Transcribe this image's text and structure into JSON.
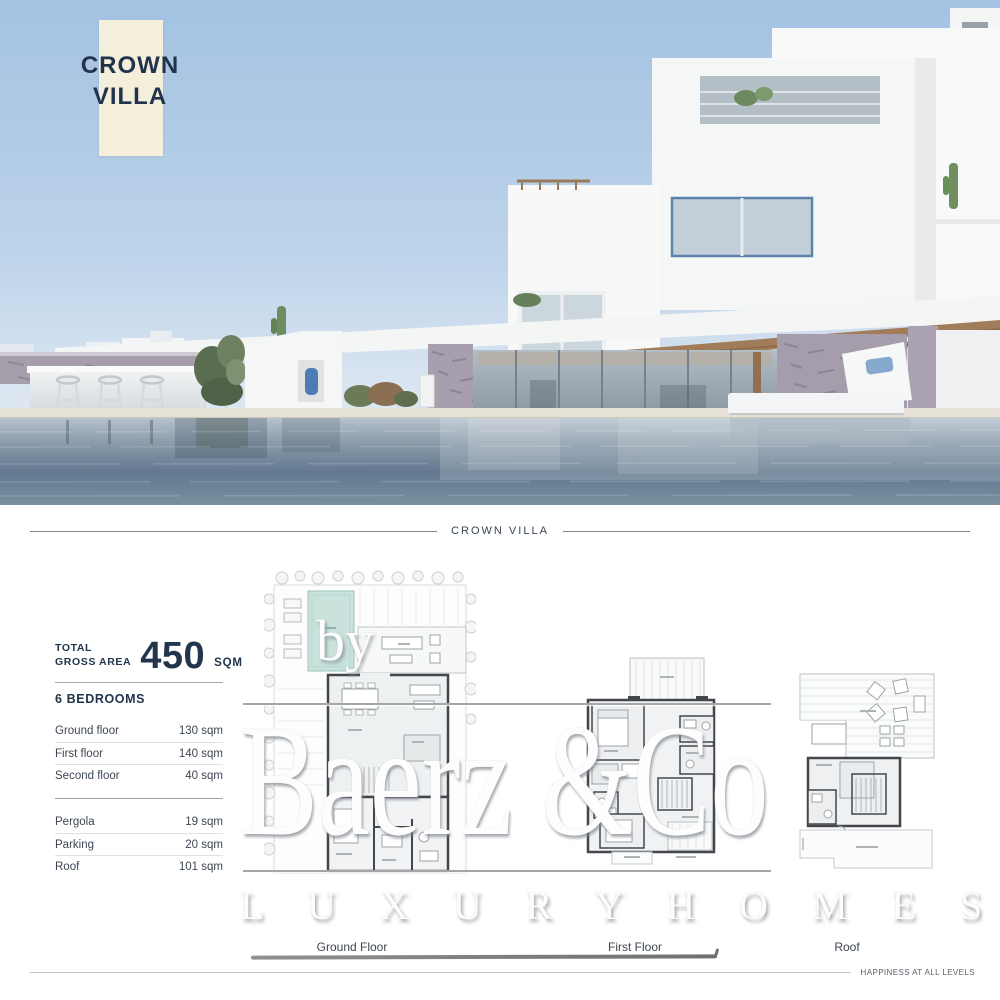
{
  "hero": {
    "card_line1": "CROWN",
    "card_line2": "VILLA"
  },
  "section_divider": {
    "title": "CROWN VILLA"
  },
  "stats": {
    "total_label_line1": "TOTAL",
    "total_label_line2": "GROSS AREA",
    "total_value": "450",
    "total_unit": "SQM",
    "bedrooms": "6 BEDROOMS",
    "floors": [
      {
        "label": "Ground floor",
        "value": "130 sqm"
      },
      {
        "label": "First floor",
        "value": "140 sqm"
      },
      {
        "label": "Second floor",
        "value": "40 sqm"
      }
    ],
    "extras": [
      {
        "label": "Pergola",
        "value": "19 sqm"
      },
      {
        "label": "Parking",
        "value": "20 sqm"
      },
      {
        "label": "Roof",
        "value": "101 sqm"
      }
    ]
  },
  "plans": {
    "ground_label": "Ground Floor",
    "first_label": "First Floor",
    "roof_label": "Roof",
    "pool_color": "#c9e2dc"
  },
  "watermark": {
    "by": "by",
    "name": "Baerz &Co",
    "tagline": "L U X U R Y   H O M E S"
  },
  "footer": {
    "tagline": "HAPPINESS AT ALL LEVELS"
  },
  "colors": {
    "navy": "#22354d",
    "cream_card": "#f4efdb",
    "sky": "#a6c4e3",
    "water": "#66798c"
  }
}
